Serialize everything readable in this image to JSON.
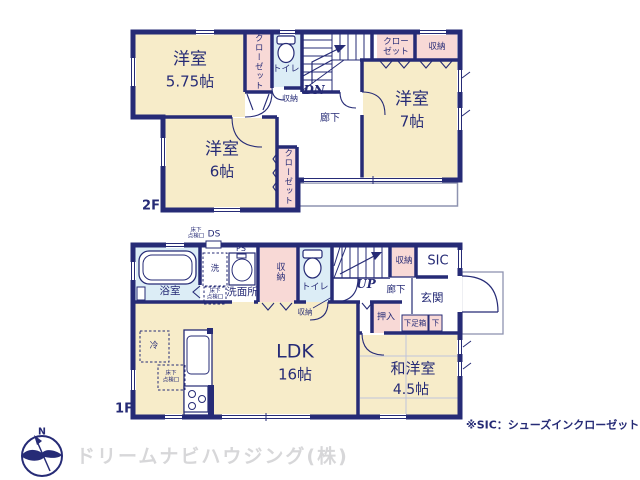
{
  "colors": {
    "wall_navy": "#262b76",
    "room_cream": "#f7ecc9",
    "closet_pink": "#f8d9d6",
    "wet_area_blue": "#dcedf6",
    "thin_gray": "#8e93b0",
    "watermark_gray": "#d7d7d9"
  },
  "floor2": {
    "label": "2F",
    "bedroom_nw": {
      "name": "洋室",
      "size": "5.75帖"
    },
    "closet_nw": "クローゼット",
    "toilet": "トイレ",
    "storage_under_stairs": "収納",
    "stairs_dir": "DN",
    "closet_ne": {
      "line1": "クロー",
      "line2": "ゼット"
    },
    "storage_ne": "収納",
    "hallway": "廊下",
    "bedroom_e": {
      "name": "洋室",
      "size": "7帖"
    },
    "bedroom_sw": {
      "name": "洋室",
      "size": "6帖"
    },
    "closet_sw": "クローゼット"
  },
  "floor1": {
    "label": "1F",
    "underfloor_hatch": {
      "line1": "床下",
      "line2": "点検口"
    },
    "ds": "DS",
    "ps": "PS",
    "bath": "浴室",
    "washer": "洗",
    "washroom": "洗面所",
    "storage_west": "収納",
    "toilet": "トイレ",
    "storage_by_toilet": "収納",
    "stairs_dir": "UP",
    "hallway": "廊下",
    "storage_hall": "収納",
    "sic": "SIC",
    "entrance": "玄関",
    "oshiire": "押入",
    "shoe_box": "下足箱",
    "shoe_box_sub": "下",
    "fridge": "冷",
    "ldk": {
      "name": "LDK",
      "size": "16帖"
    },
    "washitsu": {
      "name": "和洋室",
      "size": "4.5帖"
    }
  },
  "footer": {
    "compass_north": "N",
    "company": "ドリームナビハウジング(株)",
    "note": "※SIC：シューズインクローゼット"
  }
}
